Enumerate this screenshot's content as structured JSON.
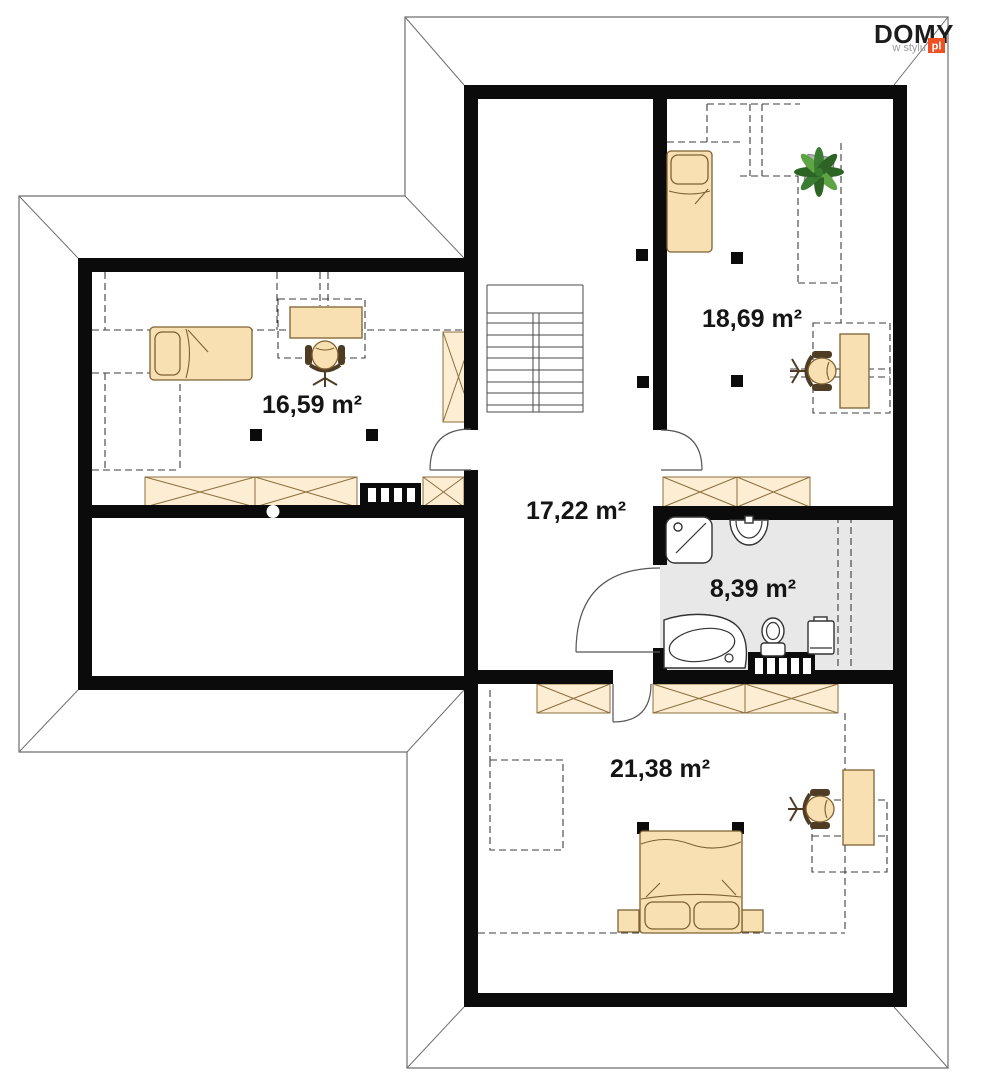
{
  "logo": {
    "brand": "DOMY",
    "tagline": "w stylu",
    "suffix": "pl"
  },
  "floorplan": {
    "floor_type": "attic-storey-plan",
    "rooms": [
      {
        "name": "room-top-left",
        "area": "16,59 m²"
      },
      {
        "name": "room-top-right",
        "area": "18,69 m²"
      },
      {
        "name": "hallway",
        "area": "17,22 m²"
      },
      {
        "name": "bathroom",
        "area": "8,39 m²"
      },
      {
        "name": "room-bottom",
        "area": "21,38 m²"
      }
    ],
    "colors": {
      "wall": "#0b0b0b",
      "furniture": "#f9e0b2",
      "cabinet": "#fcedd3",
      "bathroom_floor": "#e8e8e8",
      "plant_green_dark": "#2d6425",
      "plant_green_light": "#5ea344",
      "logo_orange": "#f05123",
      "outline_gray": "#6f6f6f"
    }
  }
}
